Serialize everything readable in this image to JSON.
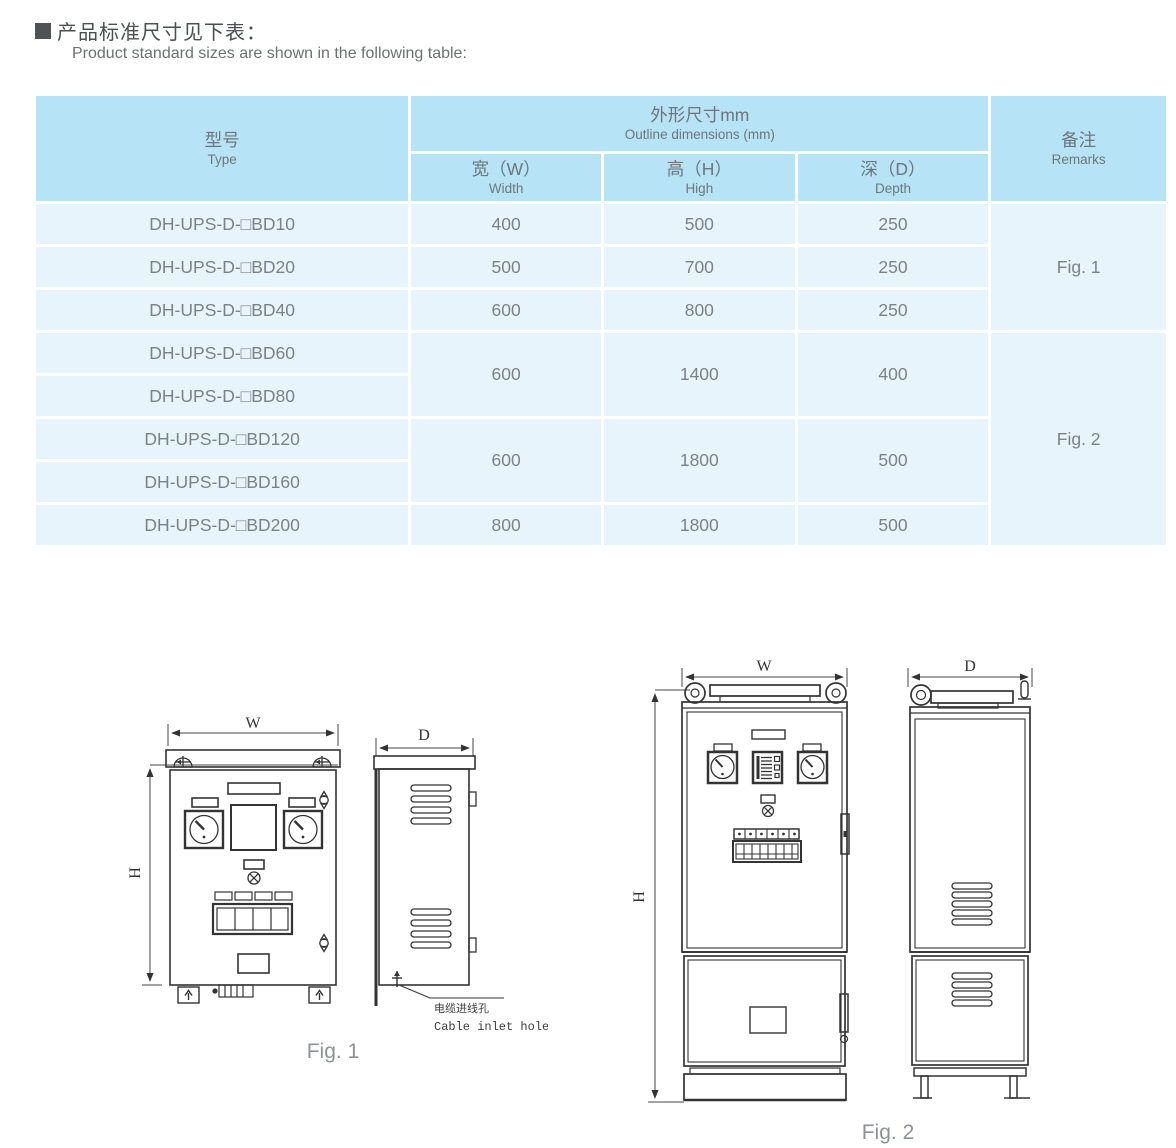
{
  "page": {
    "title_cn": "产品标准尺寸见下表：",
    "title_en": "Product standard sizes are shown in the following table:"
  },
  "table": {
    "header": {
      "type_cn": "型号",
      "type_en": "Type",
      "outline_cn": "外形尺寸mm",
      "outline_en": "Outline dimensions  (mm)",
      "w_cn": "宽（W）",
      "w_en": "Width",
      "h_cn": "高（H）",
      "h_en": "High",
      "d_cn": "深（D）",
      "d_en": "Depth",
      "remarks_cn": "备注",
      "remarks_en": "Remarks"
    },
    "rows": [
      {
        "type": "DH-UPS-D-□BD10",
        "w": "400",
        "h": "500",
        "d": "250"
      },
      {
        "type": "DH-UPS-D-□BD20",
        "w": "500",
        "h": "700",
        "d": "250"
      },
      {
        "type": "DH-UPS-D-□BD40",
        "w": "600",
        "h": "800",
        "d": "250"
      },
      {
        "type": "DH-UPS-D-□BD60",
        "w": "600",
        "h": "1400",
        "d": "400"
      },
      {
        "type": "DH-UPS-D-□BD80"
      },
      {
        "type": "DH-UPS-D-□BD120",
        "w": "600",
        "h": "1800",
        "d": "500"
      },
      {
        "type": "DH-UPS-D-□BD160"
      },
      {
        "type": "DH-UPS-D-□BD200",
        "w": "800",
        "h": "1800",
        "d": "500"
      }
    ],
    "remarks": [
      {
        "label": "Fig. 1"
      },
      {
        "label": "Fig. 2"
      }
    ]
  },
  "figures": {
    "fig1": {
      "caption": "Fig. 1",
      "dim_w": "W",
      "dim_h": "H",
      "dim_d": "D",
      "cable_label_cn": "电缆进线孔",
      "cable_label_en": "Cable inlet hole"
    },
    "fig2": {
      "caption": "Fig. 2",
      "dim_w": "W",
      "dim_h": "H",
      "dim_d": "D"
    }
  },
  "colors": {
    "table_header_bg": "#b7e3f6",
    "table_row_bg": "#e8f4fc",
    "table_text": "#7b8287",
    "title_text": "#4b4f52",
    "drawing_stroke": "#333333",
    "caption_text": "#8d9296"
  }
}
